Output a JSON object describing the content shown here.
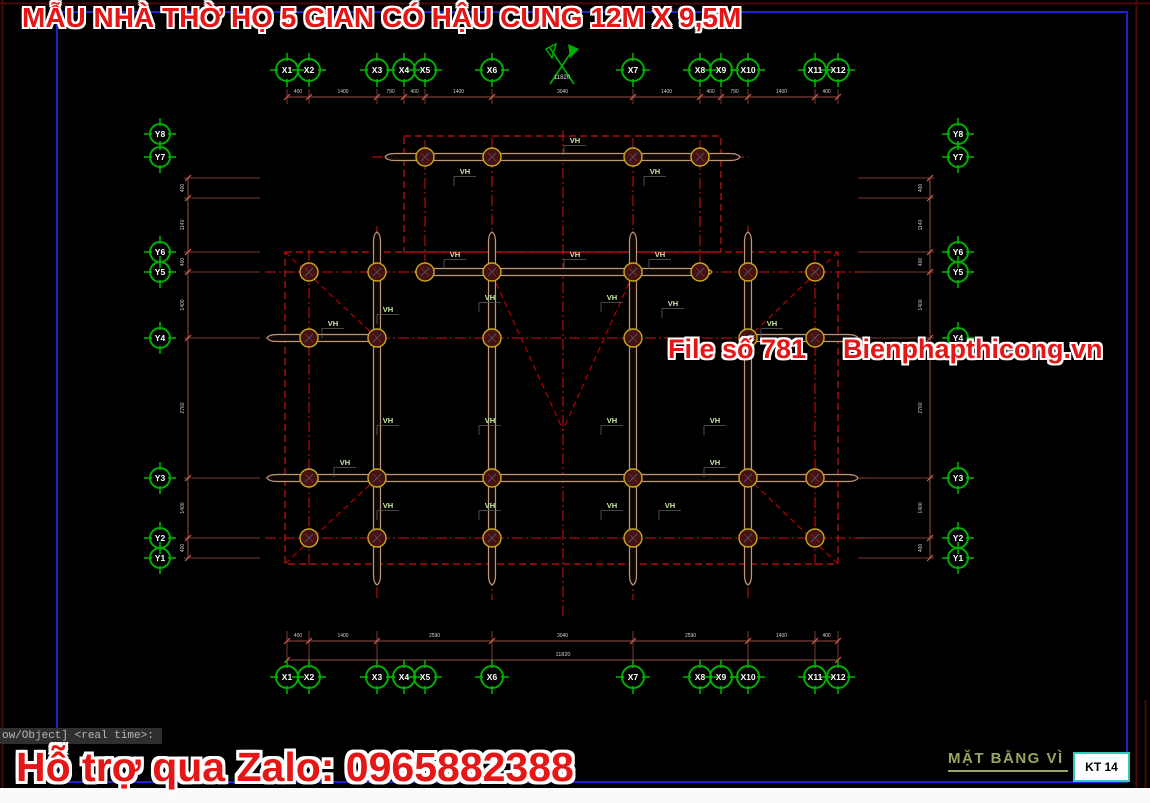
{
  "title": "MẪU NHÀ THỜ HỌ 5 GIAN CÓ HẬU CUNG 12M X 9,5M",
  "watermark": {
    "file_no": "File số 781",
    "website": "Bienphapthicong.vn",
    "support": "Hỗ trợ qua Zalo: 0965882388"
  },
  "command_line": "ow/Object] <real time>:",
  "title_block": {
    "drawing_title": "MẶT BẰNG VÌ",
    "sheet_number": "KT 14"
  },
  "axes": {
    "x_labels": [
      "X1",
      "X2",
      "X3",
      "X4",
      "X5",
      "X6",
      "X7",
      "X8",
      "X9",
      "X10",
      "X11",
      "X12"
    ],
    "y_labels": [
      "Y8",
      "Y7",
      "Y6",
      "Y5",
      "Y4",
      "Y3",
      "Y2",
      "Y1"
    ],
    "top_dims": [
      "400",
      "1400",
      "790",
      "400",
      "1400",
      "3040",
      "1400",
      "400",
      "790",
      "1400",
      "400"
    ],
    "top_total": "11820",
    "bottom_dims": [
      "400",
      "1400",
      "2590",
      "3040",
      "2590",
      "1400",
      "400"
    ],
    "bottom_total": "11820",
    "left_dims": [
      "400",
      "1140",
      "400",
      "1400",
      "2760",
      "1400",
      "400"
    ],
    "right_dims": [
      "400",
      "1140",
      "400",
      "1400",
      "2760",
      "1400",
      "400"
    ]
  },
  "plan": {
    "truss_label": "VH"
  },
  "colors": {
    "background": "#000000",
    "axis_green": "#00b000",
    "centerline_red": "#d01010",
    "diagonal_red": "#b80000",
    "dim_line_red": "#9a4a42",
    "dim_tick_red": "#d06050",
    "beam_tan": "#bf9878",
    "column_ring_yellow": "#c9a91c",
    "column_fill_maroon": "#451111",
    "watermark_red": "#e41616",
    "frame_blue": "#2020cc",
    "frame_dark_red": "#4a0808",
    "vh_label_green": "#cdeaa6",
    "sheet_title_olive": "#97a65e",
    "titleblock_border_cyan": "#35c8b8",
    "dim_text": "#cfcfcf"
  }
}
